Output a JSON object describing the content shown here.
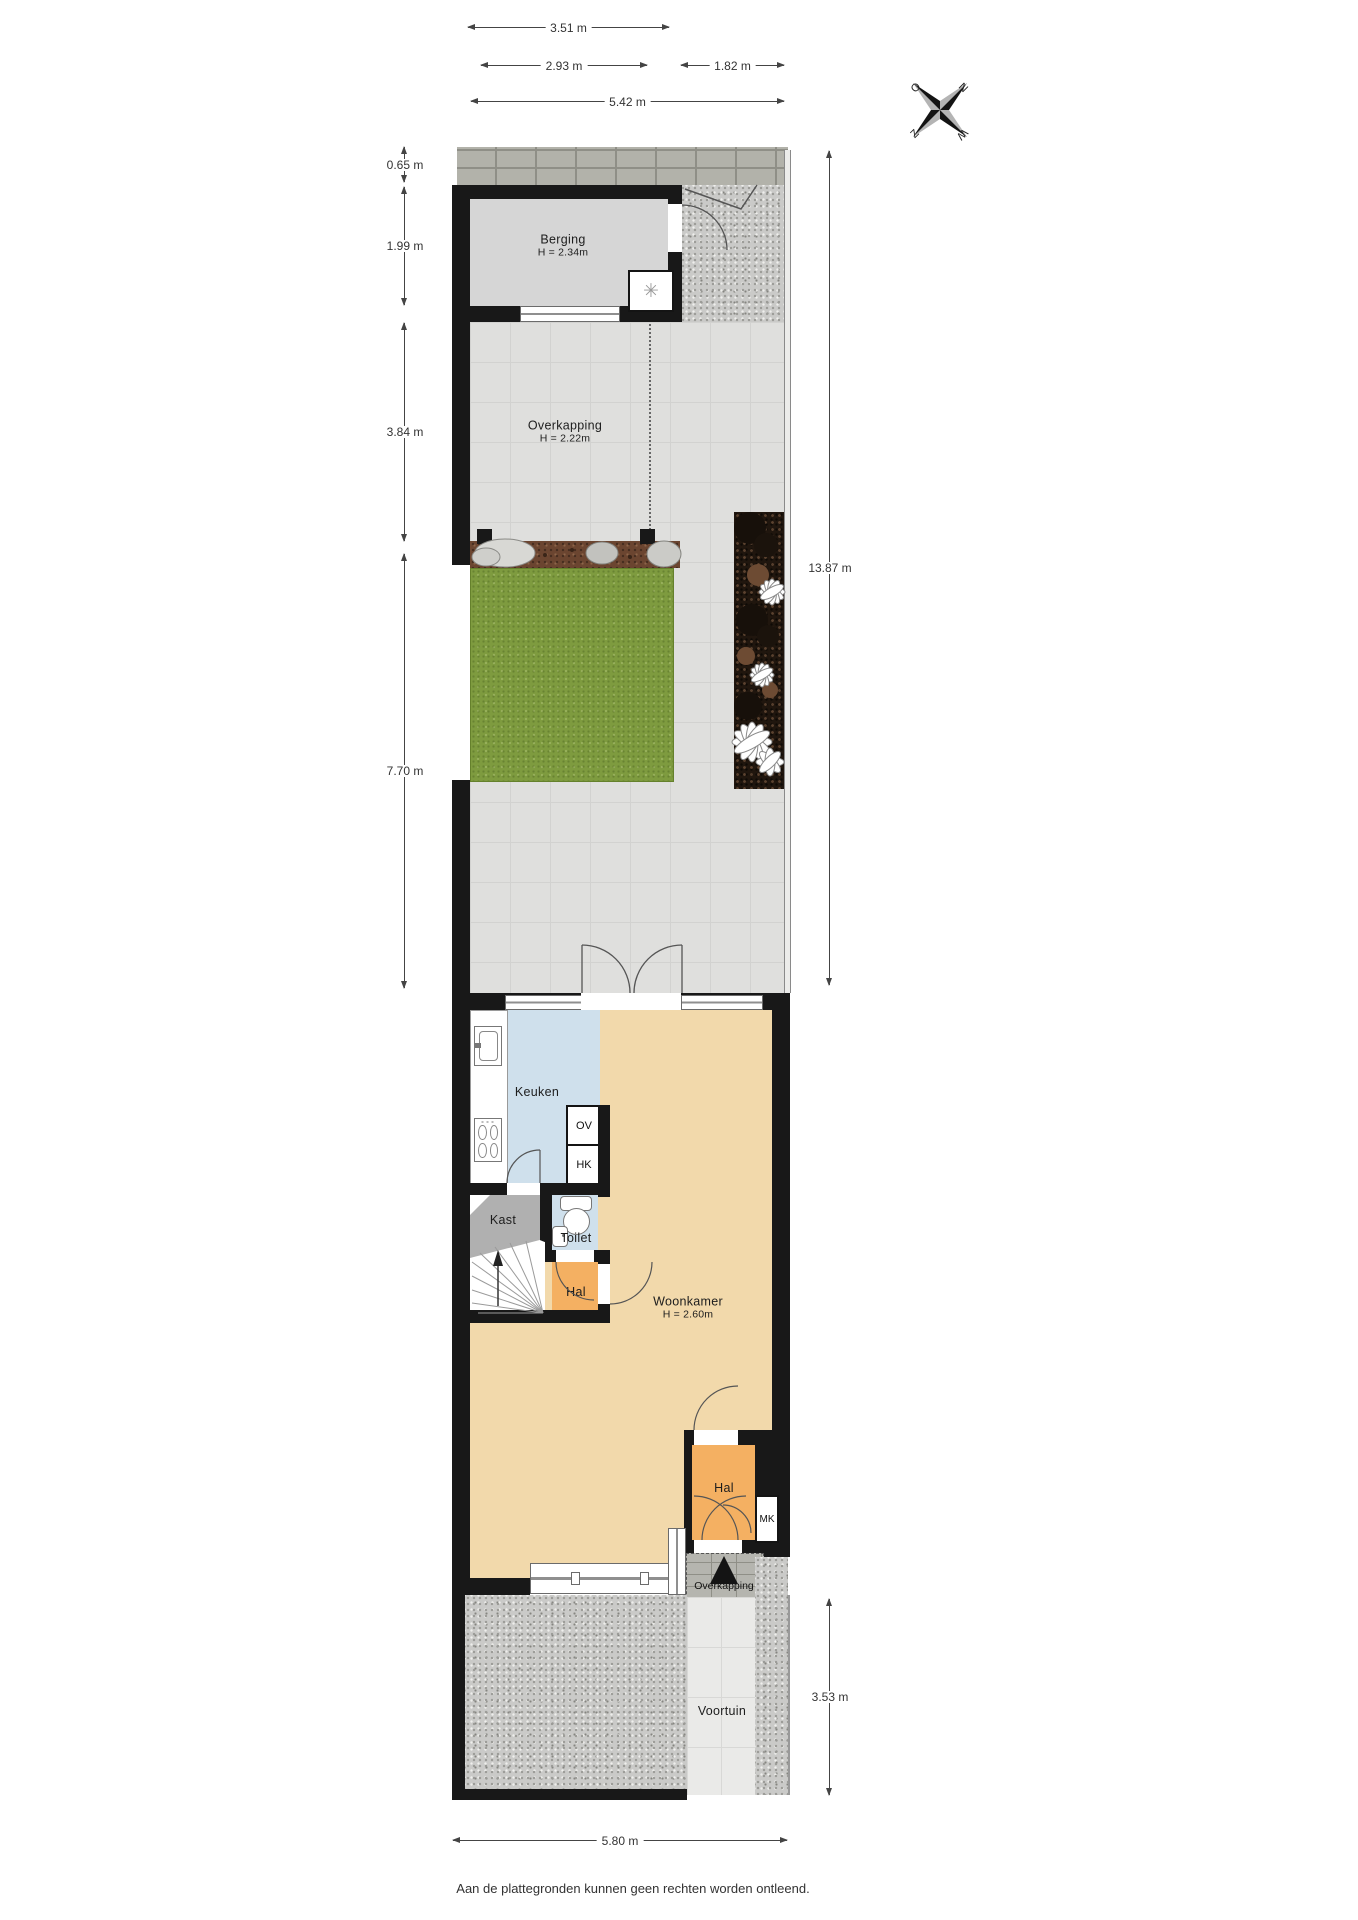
{
  "dimensions": {
    "top1": "3.51 m",
    "top2": "2.93 m",
    "top3": "1.82 m",
    "top4": "5.42 m",
    "left1": "0.65 m",
    "left2": "1.99 m",
    "left3": "3.84 m",
    "left4": "7.70 m",
    "right1": "13.87 m",
    "right2": "3.53 m",
    "bottom1": "5.80 m"
  },
  "rooms": {
    "berging": {
      "name": "Berging",
      "height": "H = 2.34m"
    },
    "overkapping_tuin": {
      "name": "Overkapping",
      "height": "H = 2.22m"
    },
    "keuken": {
      "name": "Keuken"
    },
    "kast": {
      "name": "Kast"
    },
    "toilet": {
      "name": "Toilet"
    },
    "hal_midden": {
      "name": "Hal"
    },
    "woonkamer": {
      "name": "Woonkamer",
      "height": "H = 2.60m"
    },
    "hal_entree": {
      "name": "Hal"
    },
    "meterkast": {
      "name": "MK"
    },
    "overkapping_entree": {
      "name": "Overkapping"
    },
    "voortuin": {
      "name": "Voortuin"
    }
  },
  "appliances": {
    "oven": "OV",
    "ketel": "HK"
  },
  "compass": {
    "north": "N",
    "east": "O",
    "south": "Z",
    "west": "W"
  },
  "icons": {
    "ventilation": "✳"
  },
  "footer": "Aan de plattegronden kunnen geen rechten worden ontleend.",
  "colors": {
    "wall": "#181818",
    "line": "#444444",
    "tan": "#f2d9ab",
    "orange": "#f4b062",
    "blue": "#cfe0ec",
    "gray-room": "#d6d6d6",
    "kast-gray": "#b0b0b0",
    "tile": "#dfdfdd",
    "grass": "#7e9b3f",
    "soil": "#6b4530",
    "bed": "#20160e",
    "gravel": "#cacac8",
    "brick": "#b2b2aa",
    "path": "#eaeae8"
  }
}
